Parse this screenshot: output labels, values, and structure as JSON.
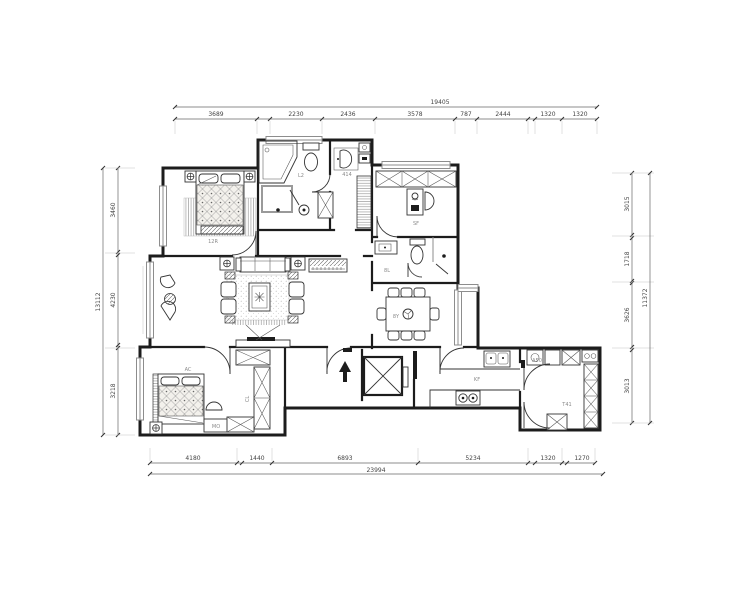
{
  "drawing": {
    "type": "residential floor plan",
    "dims": {
      "top": {
        "total": "19405",
        "segments": [
          "3689",
          "2230",
          "2436",
          "3578",
          "787",
          "2444",
          "1320",
          "1320"
        ]
      },
      "bottom": {
        "total": "23994",
        "segments": [
          "4180",
          "1440",
          "6893",
          "5234",
          "1320",
          "1270"
        ]
      },
      "left": {
        "total": "13112",
        "segments": [
          "3460",
          "4230",
          "3218"
        ]
      },
      "right": {
        "total": "11372",
        "segments": [
          "3015",
          "1718",
          "3626",
          "3013"
        ]
      }
    },
    "rooms": {
      "bedroom": "12R",
      "bath": "L2",
      "cloak": "414",
      "study": "SF",
      "bath2": "8L",
      "dining": "8Y",
      "kitchen": "KF",
      "master": "AC",
      "bench": "MO",
      "utility": "T41",
      "appliance": "A50",
      "closet": "CL"
    },
    "colors": {
      "wall": "#1c1c1c",
      "window": "#8d8d8d",
      "dim_text": "#444444"
    }
  }
}
